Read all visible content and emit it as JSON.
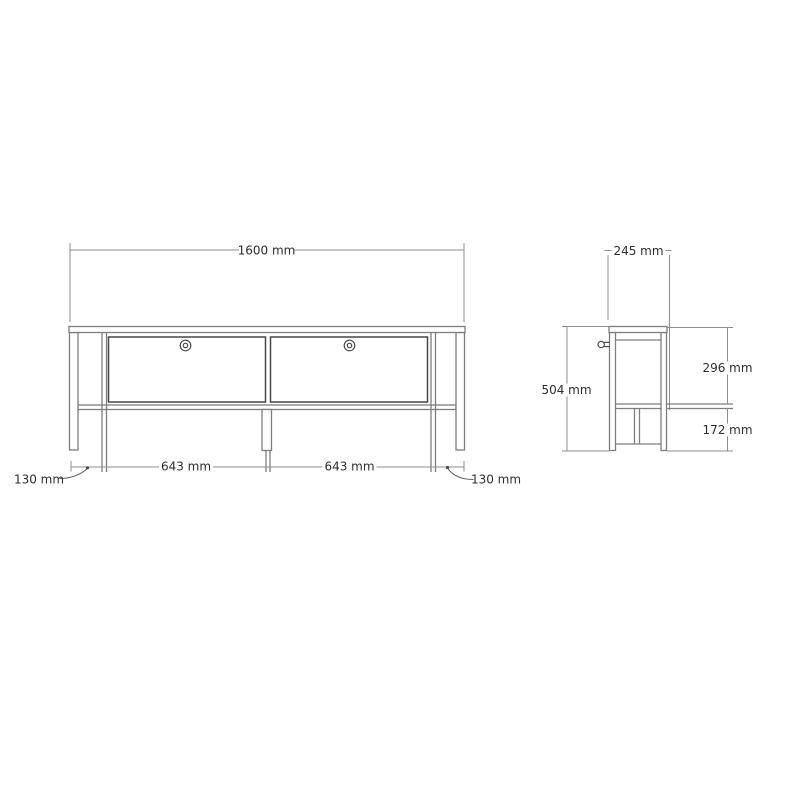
{
  "front_view": {
    "overall_width": "1600 mm",
    "drawer_widths": [
      "643 mm",
      "643 mm"
    ],
    "side_offsets": [
      "130 mm",
      "130 mm"
    ]
  },
  "side_view": {
    "depth": "245 mm",
    "height": "504 mm",
    "upper_height": "296 mm",
    "lower_height": "172 mm"
  },
  "colors": {
    "background": "#ffffff",
    "frame_line": "#7e7e7e",
    "drawer_line": "#474747",
    "dimension_line": "#8d8d8d",
    "text": "#2e2e2e"
  }
}
